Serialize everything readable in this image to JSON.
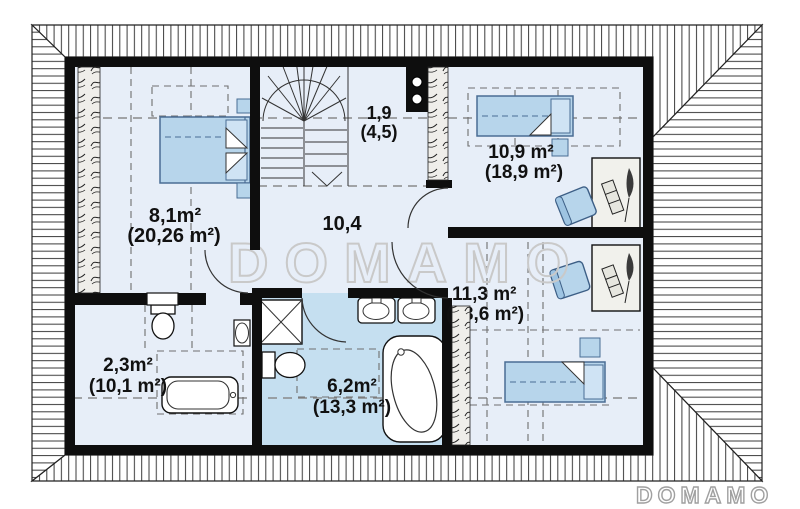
{
  "watermark": {
    "text": "DOMAMO"
  },
  "brand_logo": {
    "text": "DOMAMO"
  },
  "rooms": {
    "bedroom_left": {
      "area": "8,1m²",
      "area_total": "(20,26 m²)"
    },
    "hall": {
      "area": "10,4"
    },
    "stair_landing": {
      "area": "1,9",
      "area_total": "(4,5)"
    },
    "bedroom_top_right": {
      "area": "10,9 m²",
      "area_total": "(18,9 m²)"
    },
    "bedroom_bottom_right": {
      "area": "11,3 m²",
      "area_total": "(18,6 m²)"
    },
    "bathroom_small": {
      "area": "2,3m²",
      "area_total": "(10,1 m²)"
    },
    "bathroom_main": {
      "area": "6,2m²",
      "area_total": "(13,3 m²)"
    }
  },
  "colors": {
    "wall": "#0e0e0e",
    "room_floor": "#e7eef8",
    "bathroom_floor": "#c5dff0",
    "furniture_blue": "#b7d5eb",
    "furniture_stroke": "#4a6d94",
    "watermark_outline": "#c9c9c9",
    "logo_outline": "#a0a0a0",
    "dashed_line": "#8a8a8a"
  }
}
